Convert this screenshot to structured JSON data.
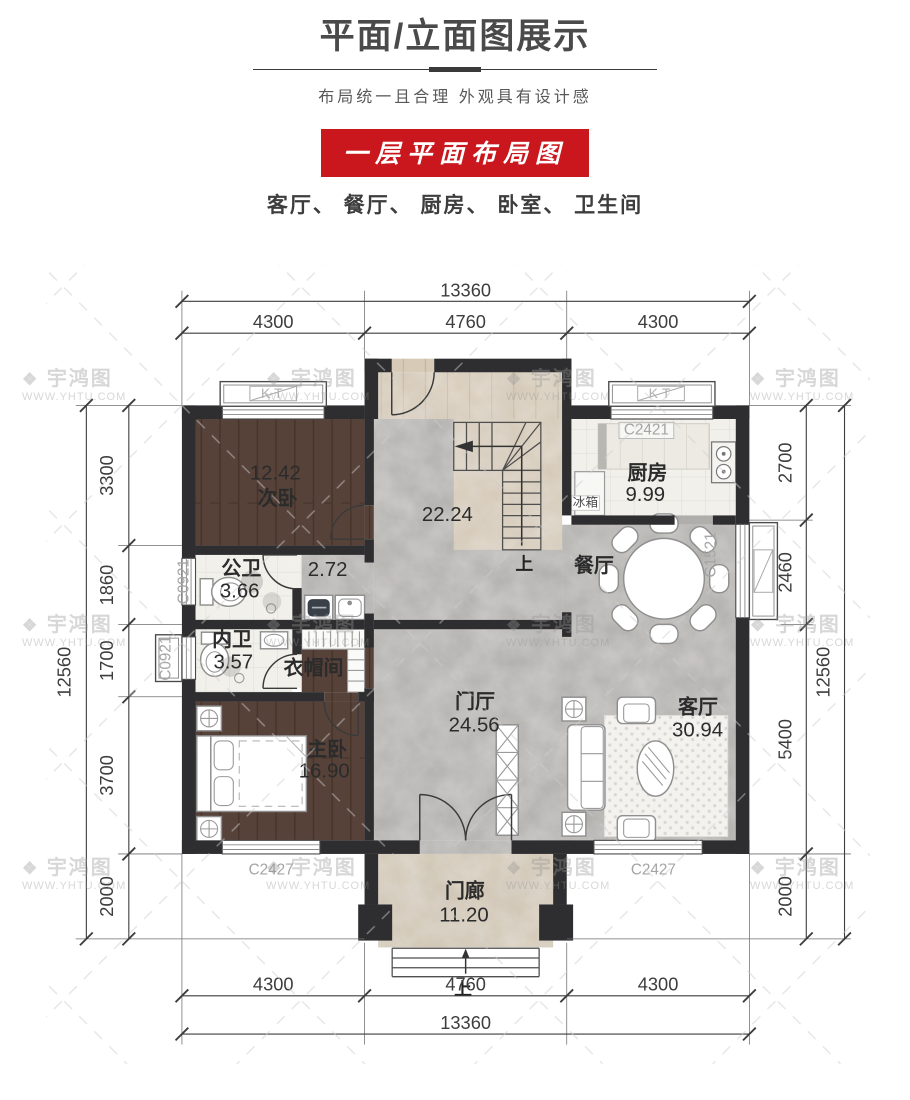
{
  "header": {
    "title": "平面/立面图展示",
    "subtitle": "布局统一且合理 外观具有设计感"
  },
  "section": {
    "banner": "一层平面布局图",
    "room_list": "客厅、 餐厅、 厨房、 卧室、 卫生间"
  },
  "watermark": {
    "logo_glyph": "❖",
    "brand": "宇鸿图",
    "url": "WWW.YHTU.COM"
  },
  "colors": {
    "banner_bg": "#c9171d",
    "wall": "#2e2e30",
    "wood_floor": "#57423a",
    "marble_floor": "#b0aeab",
    "tile_floor": "#f1f0eb",
    "tan_floor": "#d7cab6",
    "dim_line": "#3d3d3d"
  },
  "plan": {
    "rooms": {
      "secondary_bedroom": {
        "area": "12.42",
        "name": "次卧"
      },
      "stair_hall": {
        "area": "22.24"
      },
      "public_bath": {
        "name": "公卫",
        "area": "3.66"
      },
      "corridor": {
        "area": "2.72"
      },
      "private_bath": {
        "name": "内卫",
        "area": "3.57"
      },
      "cloakroom": {
        "name": "衣帽间"
      },
      "master_bedroom": {
        "name": "主卧",
        "area": "16.90"
      },
      "kitchen": {
        "name": "厨房",
        "area": "9.99"
      },
      "dining": {
        "name": "餐厅"
      },
      "foyer": {
        "name": "门厅",
        "area": "24.56"
      },
      "living": {
        "name": "客厅",
        "area": "30.94"
      },
      "porch": {
        "name": "门廊",
        "area": "11.20"
      }
    },
    "labels": {
      "fridge": "冰箱",
      "stairs_up": "上",
      "porch_up": "上",
      "kt": "KT"
    },
    "windows": {
      "kitchen_top": "C2421",
      "bath_left": "C0921",
      "bath_left_bay": "C0921",
      "dining_right_bay": "C1521",
      "master_bottom": "C2427",
      "living_bottom": "C2427"
    },
    "dims": {
      "top_total": "13360",
      "top_segs": [
        "4300",
        "4760",
        "4300"
      ],
      "bottom_total": "13360",
      "bottom_segs": [
        "4300",
        "4760",
        "4300"
      ],
      "left_total": "12560",
      "left_segs": [
        "3300",
        "1860",
        "1700",
        "3700",
        "2000"
      ],
      "right_total": "12560",
      "right_segs": [
        "2700",
        "2460",
        "5400",
        "2000"
      ]
    }
  }
}
